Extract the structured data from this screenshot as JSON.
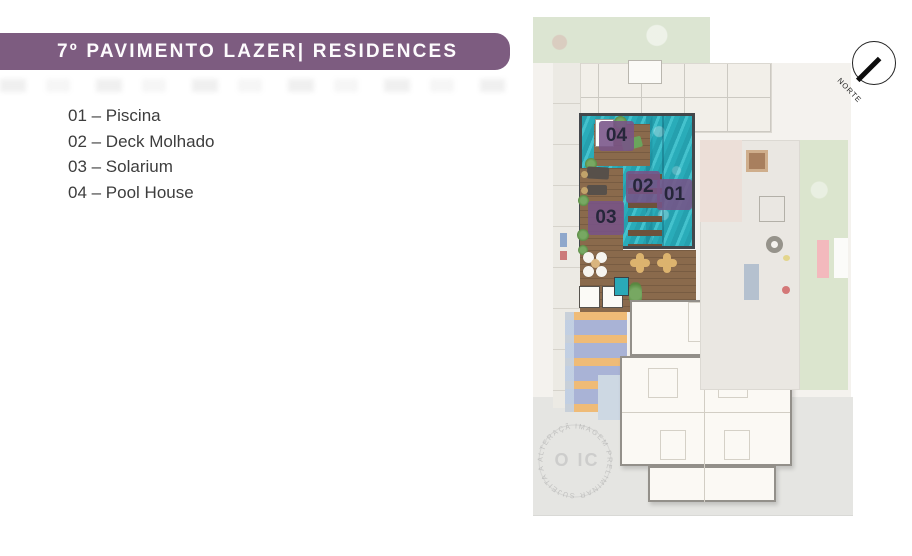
{
  "header": {
    "title": "7º PAVIMENTO LAZER| RESIDENCES"
  },
  "legend": {
    "items": [
      {
        "text": "01 – Piscina"
      },
      {
        "text": "02 – Deck Molhado"
      },
      {
        "text": "03 – Solarium"
      },
      {
        "text": "04 – Pool House"
      }
    ]
  },
  "plan": {
    "labels": {
      "n01": {
        "text": "01",
        "meaning": "Piscina"
      },
      "n02": {
        "text": "02",
        "meaning": "Deck Molhado"
      },
      "n03": {
        "text": "03",
        "meaning": "Solarium"
      },
      "n04": {
        "text": "04",
        "meaning": "Pool House"
      }
    }
  },
  "compass": {
    "label": "NORTE"
  },
  "watermark": {
    "circular_text": "IMAGEM PRELIMINAR SUJEITA A ALTERAÇÃO",
    "center_text": "O IC"
  },
  "colors": {
    "banner_purple": "#7d5c80",
    "badge_purple": "#785387",
    "pool_teal": "#30b5c2",
    "deck_wood_brown": "#8a6a4c",
    "sunbed_lavender": "#a9b3d6",
    "sunbed_orange": "#f1bb74",
    "lawn_green": "#dbe5ce",
    "ground_gray": "#e5e5e2"
  }
}
